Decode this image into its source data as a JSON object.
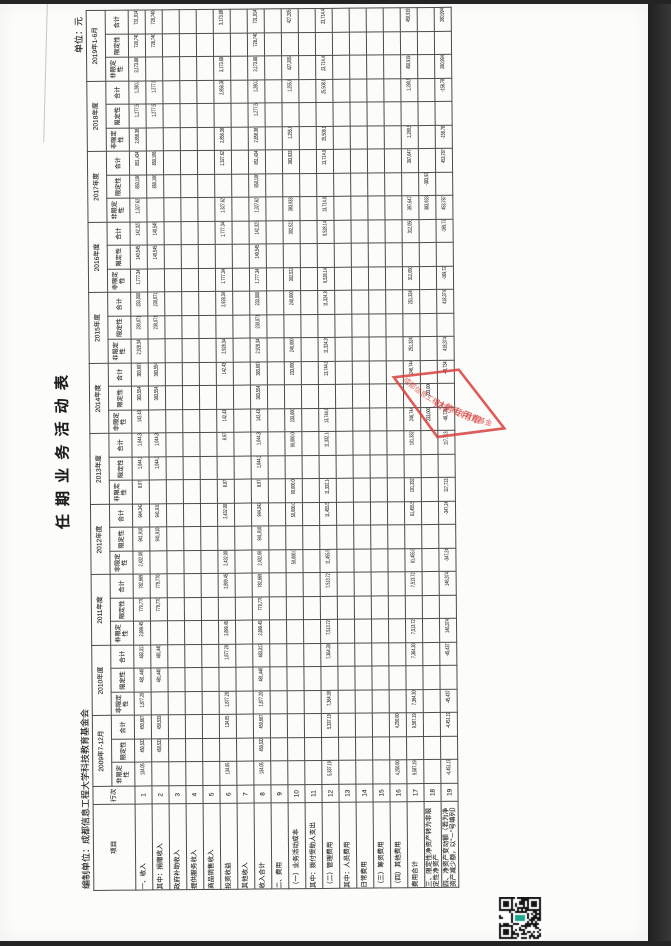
{
  "doc": {
    "title": "任 期 业 务 活 动 表",
    "prepared_by": "编制单位：成都信息工程大学科技教育基金会",
    "unit_label": "单位：元"
  },
  "stamp": {
    "arc_text": "成都信息工程大学科技教育基金会",
    "center_text": "财务专用章",
    "color": "#d8403c"
  },
  "qr": {
    "center_color": "#1fa58c",
    "module_color": "#141414"
  },
  "table": {
    "col_item": "项目",
    "col_line": "行次",
    "subheaders": [
      "非限定性",
      "限定性",
      "合计"
    ],
    "years": [
      "2009年7-12月",
      "2010年度",
      "2011年度",
      "2012年度",
      "2013年度",
      "2014年度",
      "2015年度",
      "2016年度",
      "2017年度",
      "2018年度",
      "2019年1-6月"
    ],
    "rows": [
      {
        "label": "一、收入",
        "line": "1",
        "section": true,
        "cells": [
          [
            "134.05",
            "450,533.50",
            "450,667.55"
          ],
          [
            "1,877.20",
            "481,440.15",
            "483,317.35"
          ],
          [
            "2,899.45",
            "779,770.00",
            "782,669.45"
          ],
          [
            "2,432.00",
            "941,910.00",
            "944,342.00"
          ],
          [
            "8.97",
            "1,044,333.03",
            "1,044,342.00"
          ],
          [
            "142.43",
            "383,554.99",
            "383,697.42"
          ],
          [
            "2,928.34",
            "230,071.66",
            "233,000.00"
          ],
          [
            "1,777.34",
            "140,545.88",
            "142,323.22"
          ],
          [
            "1,327.62",
            "850,106.75",
            "851,434.37"
          ],
          [
            "2,858.38",
            "1,277,532.96",
            "1,280,391.34"
          ],
          [
            "3,173.88",
            "728,740.18",
            "731,914.06"
          ]
        ]
      },
      {
        "label": "其中：捐赠收入",
        "line": "2",
        "section": false,
        "cells": [
          [
            "",
            "450,533.50",
            "450,533.50"
          ],
          [
            "",
            "481,440.15",
            "481,440.15"
          ],
          [
            "",
            "779,770.00",
            "779,770.00"
          ],
          [
            "",
            "941,910.00",
            "941,910.00"
          ],
          [
            "",
            "1,044,333.03",
            "1,044,333.03"
          ],
          [
            "",
            "383,554.99",
            "383,554.99"
          ],
          [
            "",
            "230,071.66",
            "230,071.66"
          ],
          [
            "",
            "140,545.88",
            "140,545.88"
          ],
          [
            "",
            "850,106.75",
            "850,106.75"
          ],
          [
            "",
            "1,277,532.96",
            "1,277,532.96"
          ],
          [
            "",
            "728,740.18",
            "728,740.18"
          ]
        ]
      },
      {
        "label": "政府补助收入",
        "line": "3",
        "section": false,
        "cells": [
          [
            "",
            "",
            ""
          ],
          [
            "",
            "",
            ""
          ],
          [
            "",
            "",
            ""
          ],
          [
            "",
            "",
            ""
          ],
          [
            "",
            "",
            ""
          ],
          [
            "",
            "",
            ""
          ],
          [
            "",
            "",
            ""
          ],
          [
            "",
            "",
            ""
          ],
          [
            "",
            "",
            ""
          ],
          [
            "",
            "",
            ""
          ],
          [
            "",
            "",
            ""
          ]
        ]
      },
      {
        "label": "提供服务收入",
        "line": "4",
        "section": false,
        "cells": [
          [
            "",
            "",
            ""
          ],
          [
            "",
            "",
            ""
          ],
          [
            "",
            "",
            ""
          ],
          [
            "",
            "",
            ""
          ],
          [
            "",
            "",
            ""
          ],
          [
            "",
            "",
            ""
          ],
          [
            "",
            "",
            ""
          ],
          [
            "",
            "",
            ""
          ],
          [
            "",
            "",
            ""
          ],
          [
            "",
            "",
            ""
          ],
          [
            "",
            "",
            ""
          ]
        ]
      },
      {
        "label": "商品销售收入",
        "line": "5",
        "section": false,
        "cells": [
          [
            "",
            "",
            ""
          ],
          [
            "",
            "",
            ""
          ],
          [
            "",
            "",
            ""
          ],
          [
            "",
            "",
            ""
          ],
          [
            "",
            "",
            ""
          ],
          [
            "",
            "",
            ""
          ],
          [
            "",
            "",
            ""
          ],
          [
            "",
            "",
            ""
          ],
          [
            "",
            "",
            ""
          ],
          [
            "",
            "",
            ""
          ],
          [
            "",
            "",
            ""
          ]
        ]
      },
      {
        "label": "投资收益",
        "line": "6",
        "section": false,
        "cells": [
          [
            "134.05",
            "",
            "134.05"
          ],
          [
            "1,877.20",
            "",
            "1,877.20"
          ],
          [
            "2,899.45",
            "",
            "2,899.45"
          ],
          [
            "2,432.00",
            "",
            "2,432.00"
          ],
          [
            "8.97",
            "",
            "8.97"
          ],
          [
            "142.43",
            "",
            "142.43"
          ],
          [
            "2,928.34",
            "",
            "2,928.34"
          ],
          [
            "1,777.34",
            "",
            "1,777.34"
          ],
          [
            "1,327.62",
            "",
            "1,327.62"
          ],
          [
            "2,858.38",
            "",
            "2,858.38"
          ],
          [
            "3,173.88",
            "",
            "3,173.88"
          ]
        ]
      },
      {
        "label": "其他收入",
        "line": "7",
        "section": false,
        "cells": [
          [
            "",
            "",
            ""
          ],
          [
            "",
            "",
            ""
          ],
          [
            "",
            "",
            ""
          ],
          [
            "",
            "",
            ""
          ],
          [
            "",
            "",
            ""
          ],
          [
            "",
            "",
            ""
          ],
          [
            "",
            "",
            ""
          ],
          [
            "",
            "",
            ""
          ],
          [
            "",
            "",
            ""
          ],
          [
            "",
            "",
            ""
          ],
          [
            "",
            "",
            ""
          ]
        ]
      },
      {
        "label": "收入合计",
        "line": "8",
        "section": false,
        "cells": [
          [
            "134.05",
            "450,533.50",
            "450,667.55"
          ],
          [
            "1,877.20",
            "481,440.15",
            "483,317.35"
          ],
          [
            "2,899.45",
            "779,770.00",
            "782,669.45"
          ],
          [
            "2,432.00",
            "941,910.00",
            "944,342.00"
          ],
          [
            "8.97",
            "1,044,333.03",
            "1,044,342.00"
          ],
          [
            "142.43",
            "383,554.99",
            "383,697.42"
          ],
          [
            "2,928.34",
            "230,071.66",
            "233,000.00"
          ],
          [
            "1,777.34",
            "140,545.88",
            "142,323.22"
          ],
          [
            "1,327.62",
            "850,106.75",
            "851,434.37"
          ],
          [
            "2,858.38",
            "1,277,532.96",
            "1,280,391.34"
          ],
          [
            "3,173.88",
            "728,740.18",
            "731,914.06"
          ]
        ]
      },
      {
        "label": "二、费用",
        "line": "9",
        "section": true,
        "cells": [
          [
            "",
            "",
            ""
          ],
          [
            "",
            "",
            ""
          ],
          [
            "",
            "",
            ""
          ],
          [
            "",
            "",
            ""
          ],
          [
            "",
            "",
            ""
          ],
          [
            "",
            "",
            ""
          ],
          [
            "",
            "",
            ""
          ],
          [
            "",
            "",
            ""
          ],
          [
            "",
            "",
            ""
          ],
          [
            "",
            "",
            ""
          ],
          [
            "",
            "",
            ""
          ]
        ]
      },
      {
        "label": "（一）业务活动成本",
        "line": "10",
        "section": false,
        "cells": [
          [
            "",
            "",
            ""
          ],
          [
            "",
            "",
            ""
          ],
          [
            "",
            "",
            ""
          ],
          [
            "50,000.00",
            "",
            "50,000.00"
          ],
          [
            "90,000.00",
            "",
            "90,000.00"
          ],
          [
            "233,000.00",
            "",
            "233,000.00"
          ],
          [
            "240,000.00",
            "",
            "240,000.00"
          ],
          [
            "302,522.00",
            "",
            "302,522.00"
          ],
          [
            "383,933.00",
            "",
            "383,933.00"
          ],
          [
            "1,255,040.98",
            "",
            "1,255,040.98"
          ],
          [
            "427,205.49",
            "",
            "427,205.49"
          ]
        ]
      },
      {
        "label": "其中：拨付受助人支出",
        "line": "11",
        "section": false,
        "cells": [
          [
            "",
            "",
            ""
          ],
          [
            "",
            "",
            ""
          ],
          [
            "",
            "",
            ""
          ],
          [
            "",
            "",
            ""
          ],
          [
            "",
            "",
            ""
          ],
          [
            "",
            "",
            ""
          ],
          [
            "",
            "",
            ""
          ],
          [
            "",
            "",
            ""
          ],
          [
            "",
            "",
            ""
          ],
          [
            "",
            "",
            ""
          ],
          [
            "",
            "",
            ""
          ]
        ]
      },
      {
        "label": "（二）管理费用",
        "line": "12",
        "section": false,
        "cells": [
          [
            "5,337.19",
            "",
            "5,337.19"
          ],
          [
            "7,364.30",
            "",
            "7,364.30"
          ],
          [
            "7,513.72",
            "",
            "7,513.72"
          ],
          [
            "11,455.58",
            "",
            "11,455.58"
          ],
          [
            "11,332.14",
            "",
            "11,332.14"
          ],
          [
            "13,744.00",
            "",
            "13,744.00"
          ],
          [
            "11,324.20",
            "",
            "11,324.20"
          ],
          [
            "9,528.14",
            "",
            "9,528.14"
          ],
          [
            "13,714.02",
            "",
            "13,714.02"
          ],
          [
            "25,508.14",
            "",
            "25,508.14"
          ],
          [
            "23,714.43",
            "",
            "23,714.43"
          ]
        ]
      },
      {
        "label": "其中：人员费用",
        "line": "13",
        "section": false,
        "cells": [
          [
            "",
            "",
            ""
          ],
          [
            "",
            "",
            ""
          ],
          [
            "",
            "",
            ""
          ],
          [
            "",
            "",
            ""
          ],
          [
            "",
            "",
            ""
          ],
          [
            "",
            "",
            ""
          ],
          [
            "",
            "",
            ""
          ],
          [
            "",
            "",
            ""
          ],
          [
            "",
            "",
            ""
          ],
          [
            "",
            "",
            ""
          ],
          [
            "",
            "",
            ""
          ]
        ]
      },
      {
        "label": "日常费用",
        "line": "14",
        "section": false,
        "cells": [
          [
            "",
            "",
            ""
          ],
          [
            "",
            "",
            ""
          ],
          [
            "",
            "",
            ""
          ],
          [
            "",
            "",
            ""
          ],
          [
            "",
            "",
            ""
          ],
          [
            "",
            "",
            ""
          ],
          [
            "",
            "",
            ""
          ],
          [
            "",
            "",
            ""
          ],
          [
            "",
            "",
            ""
          ],
          [
            "",
            "",
            ""
          ],
          [
            "",
            "",
            ""
          ]
        ]
      },
      {
        "label": "（三）筹资费用",
        "line": "15",
        "section": false,
        "cells": [
          [
            "",
            "",
            ""
          ],
          [
            "",
            "",
            ""
          ],
          [
            "",
            "",
            ""
          ],
          [
            "",
            "",
            ""
          ],
          [
            "",
            "",
            ""
          ],
          [
            "",
            "",
            ""
          ],
          [
            "",
            "",
            ""
          ],
          [
            "",
            "",
            ""
          ],
          [
            "",
            "",
            ""
          ],
          [
            "",
            "",
            ""
          ],
          [
            "",
            "",
            ""
          ]
        ]
      },
      {
        "label": "（四）其他费用",
        "line": "16",
        "section": false,
        "cells": [
          [
            "4,250.00",
            "",
            "4,250.00"
          ],
          [
            "",
            "",
            ""
          ],
          [
            "",
            "",
            ""
          ],
          [
            "",
            "",
            ""
          ],
          [
            "",
            "",
            ""
          ],
          [
            "",
            "",
            ""
          ],
          [
            "",
            "",
            ""
          ],
          [
            "",
            "",
            ""
          ],
          [
            "",
            "",
            ""
          ],
          [
            "",
            "",
            ""
          ],
          [
            "",
            "",
            ""
          ]
        ]
      },
      {
        "label": "费用合计",
        "line": "17",
        "section": false,
        "cells": [
          [
            "9,587.19",
            "",
            "9,587.19"
          ],
          [
            "7,364.30",
            "",
            "7,364.30"
          ],
          [
            "7,513.72",
            "",
            "7,513.72"
          ],
          [
            "61,455.58",
            "",
            "61,455.58"
          ],
          [
            "101,332.14",
            "",
            "101,332.14"
          ],
          [
            "246,744.00",
            "",
            "246,744.00"
          ],
          [
            "251,324.20",
            "",
            "251,324.20"
          ],
          [
            "312,050.14",
            "",
            "312,050.14"
          ],
          [
            "397,647.02",
            "",
            "397,647.02"
          ],
          [
            "1,280,549.12",
            "",
            "1,280,549.12"
          ],
          [
            "450,919.92",
            "",
            "450,919.92"
          ]
        ]
      },
      {
        "label": "三、限定性净资产转为非限定性净资产",
        "line": "18",
        "section": true,
        "cells": [
          [
            "",
            "",
            ""
          ],
          [
            "",
            "",
            ""
          ],
          [
            "",
            "",
            ""
          ],
          [
            "",
            "",
            ""
          ],
          [
            "",
            "",
            ""
          ],
          [
            "233,000.00",
            "-233,000.00",
            ""
          ],
          [
            "",
            "",
            ""
          ],
          [
            "",
            "",
            ""
          ],
          [
            "383,933.00",
            "-383,933.00",
            ""
          ],
          [
            "",
            "",
            ""
          ],
          [
            "",
            "",
            ""
          ]
        ]
      },
      {
        "label": "四、净资产变动额（若为净资产减少额，以“－”号填列）",
        "line": "19",
        "section": true,
        "cells": [
          [
            "-4,451.19",
            "",
            "-4,451.19"
          ],
          [
            "-45,437.13",
            "",
            "-45,437.13"
          ],
          [
            "146,374.47",
            "",
            "146,374.47"
          ],
          [
            "-347,243.43",
            "",
            "-347,243.43"
          ],
          [
            "117,713.43",
            "",
            "117,713.43"
          ],
          [
            "-48,734.43",
            "",
            "-48,734.43"
          ],
          [
            "418,374.47",
            "",
            "418,374.47"
          ],
          [
            "-169,726.92",
            "",
            "-169,726.92"
          ],
          [
            "453,787.35",
            "",
            "453,787.35"
          ],
          [
            "-158.78",
            "",
            "-158.78"
          ],
          [
            "280,994.14",
            "",
            "280,994.14"
          ]
        ]
      }
    ]
  }
}
